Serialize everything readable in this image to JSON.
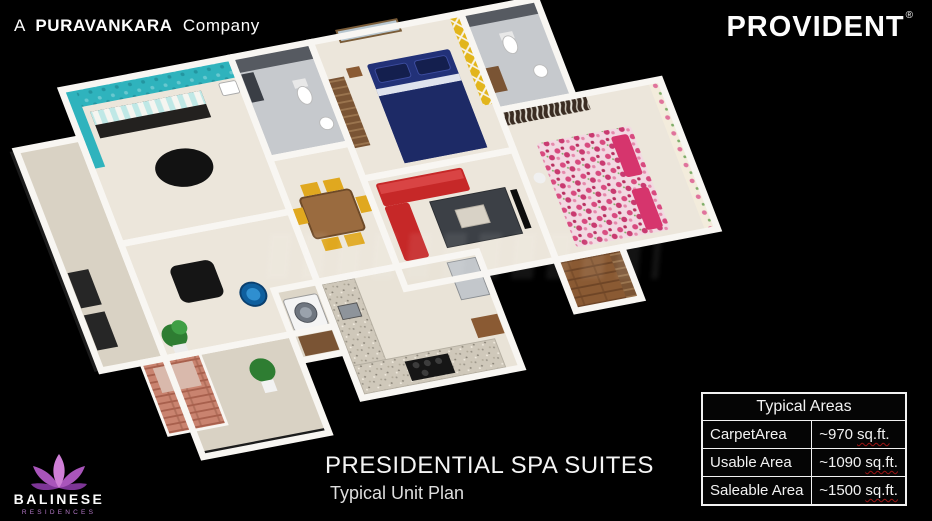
{
  "header": {
    "company_prefix": "A",
    "company_brand": "PURAVANKARA",
    "company_suffix": "Company",
    "brand_logo": "PROVIDENT",
    "registered_mark": "®"
  },
  "project": {
    "title": "PRESIDENTIAL SPA SUITES",
    "subtitle": "Typical Unit Plan"
  },
  "developer_logo": {
    "name": "BALINESE",
    "tagline": "RESIDENCES",
    "icon": "lotus-flower-icon"
  },
  "areas_table": {
    "title": "Typical Areas",
    "rows": [
      {
        "label": "CarpetArea",
        "value": "~970",
        "unit": "sq.ft."
      },
      {
        "label": "Usable Area",
        "value": "~1090",
        "unit": "sq.ft."
      },
      {
        "label": "Saleable Area",
        "value": "~1500",
        "unit": "sq.ft."
      }
    ]
  },
  "floorplan": {
    "colors": {
      "background": "#000000",
      "wall_white": "#f8f6f2",
      "floor_beige": "#ece6db",
      "spa_teal": "#2fb3bd",
      "accent_yellow": "#e2b51c",
      "bed_blue": "#223178",
      "bed_pink_floral": "#e2678f",
      "sofa_red": "#c62828",
      "chair_yellow": "#e0a81f",
      "foot_bowl_blue": "#0f5f9e",
      "planter_terracotta": "#c9836f",
      "bath_tile_gray": "#565a61",
      "wood_brown": "#8a5a33",
      "logo_purple": "#a955bb",
      "squiggle_red": "#9c1414"
    }
  }
}
